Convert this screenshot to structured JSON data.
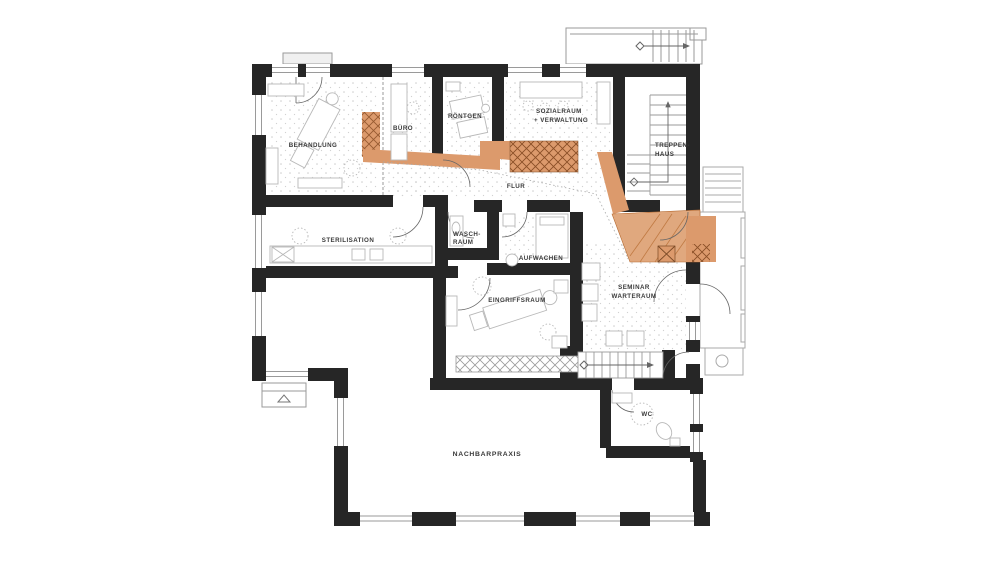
{
  "plan": {
    "type": "architectural-floor-plan",
    "rooms": {
      "behandlung": {
        "label": "BEHANDLUNG"
      },
      "buero": {
        "label": "BÜRO"
      },
      "roentgen": {
        "label": "RÖNTGEN"
      },
      "sozialraum": {
        "line1": "SOZIALRAUM",
        "line2": "+ VERWALTUNG"
      },
      "treppenhaus": {
        "line1": "TREPPEN-",
        "line2": "HAUS"
      },
      "flur": {
        "label": "FLUR"
      },
      "sterilisation": {
        "label": "STERILISATION"
      },
      "waschraum": {
        "line1": "WASCH-",
        "line2": "RAUM"
      },
      "aufwachen": {
        "label": "AUFWACHEN"
      },
      "eingriffsraum": {
        "label": "EINGRIFFSRAUM"
      },
      "seminar": {
        "line1": "SEMINAR",
        "line2": "WARTERAUM"
      },
      "wc": {
        "label": "WC"
      },
      "nachbarpraxis": {
        "label": "NACHBARPRAXIS"
      }
    },
    "colors": {
      "wall": "#262626",
      "accent": "#dc9a6c",
      "accent_light": "#e0a87e",
      "accent_dark": "#b5692f",
      "line": "#9a9a9a",
      "text": "#3a3a3a",
      "background": "#ffffff"
    }
  }
}
